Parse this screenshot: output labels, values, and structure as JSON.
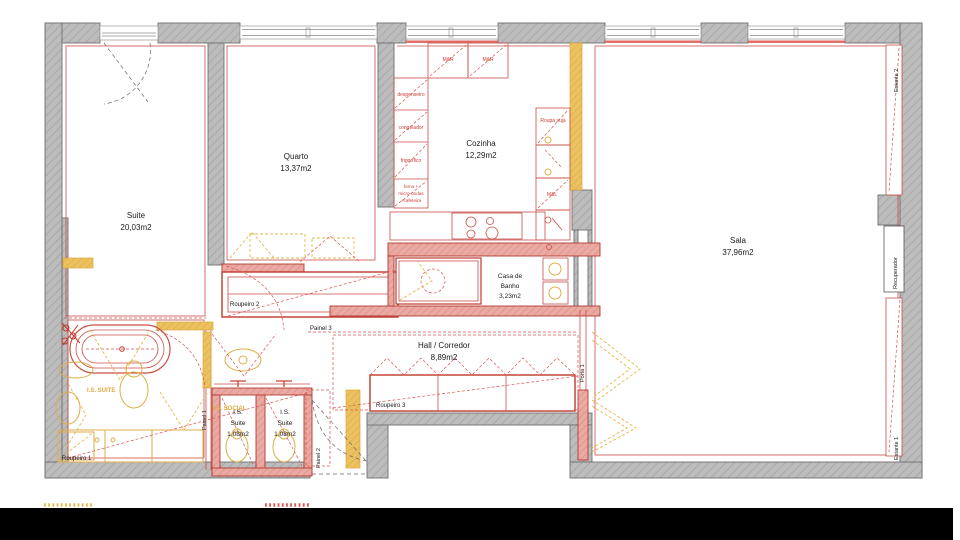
{
  "title": "Planta de apartamento",
  "colors": {
    "wall_gray": "#b9b9b9",
    "wall_edge": "#6f6f6f",
    "partition_red": "#c0392b",
    "partition_pink": "#eaaaa3",
    "existing_gold": "#e2b04a",
    "text_black": "#1a1a1a",
    "footer_bar": "#000000"
  },
  "rooms": {
    "suite": {
      "name": "Suite",
      "area": "20,03m2"
    },
    "quarto": {
      "name": "Quarto",
      "area": "13,37m2"
    },
    "cozinha": {
      "name": "Cozinha",
      "area": "12,29m2"
    },
    "sala": {
      "name": "Sala",
      "area": "37,96m2"
    },
    "casa_banho": {
      "line1": "Casa de",
      "line2": "Banho",
      "area": "3,23m2"
    },
    "hall": {
      "name": "Hall / Corredor",
      "area": "8,89m2"
    },
    "is_suite_left": {
      "line1": "I.S.",
      "line2": "Suite",
      "area": "1,08m2"
    },
    "is_suite_right": {
      "line1": "I.S.",
      "line2": "Suite",
      "area": "1,08m2"
    }
  },
  "labels": {
    "roupeiro1": "Roupeiro 1",
    "roupeiro2": "Roupeiro 2",
    "roupeiro3": "Roupeiro 3",
    "painel1": "Painel 1",
    "painel2": "Painel 2",
    "painel3": "Painel 3",
    "porta1": "Porta 1",
    "estante1": "Estante 1",
    "estante2": "Estante 2",
    "recuperador": "Recuperador",
    "is_suite_tag": "I.S. SUITE",
    "is_social_tag": "I.S. SOCIAL"
  },
  "kitchen": {
    "mr1": "M&R",
    "mr2": "M&R",
    "despenseiro": "despenseiro",
    "congelador": "congelador",
    "frigorifico": "frigorífico",
    "forno_l1": "forno +",
    "forno_l2": "micro-ondas",
    "forno_l3": "+cafeteira",
    "roupa_suja": "Roupa suja",
    "mel": "M&L"
  }
}
